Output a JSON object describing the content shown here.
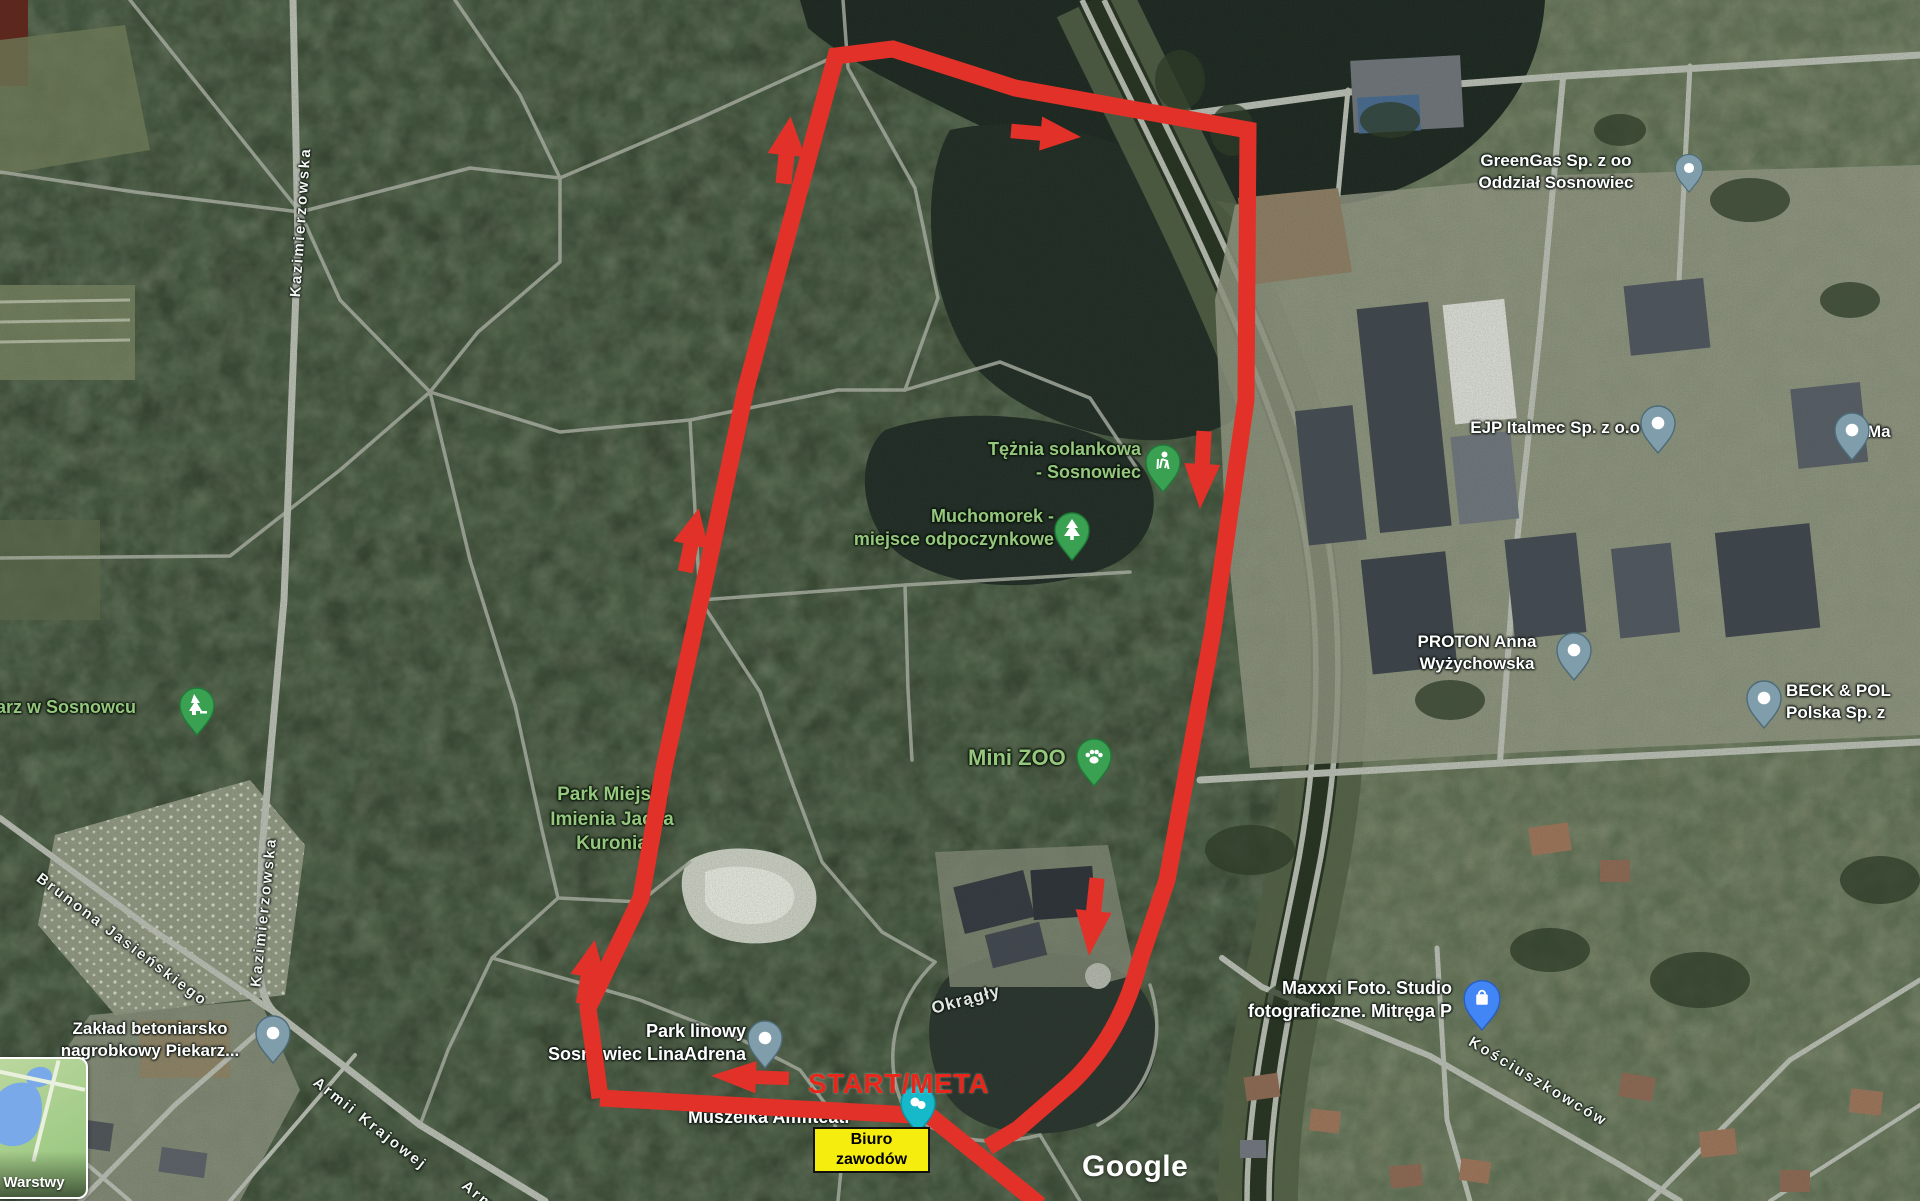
{
  "map_labels": {
    "greengas_line1": "GreenGas Sp. z oo",
    "greengas_line2": "Oddział Sosnowiec",
    "ejp": "EJP Italmec Sp. z o.o",
    "ma_cut": "Ma",
    "proton_line1": "PROTON Anna",
    "proton_line2": "Wyżychowska",
    "beck_line1": "BECK & POL",
    "beck_line2": "Polska Sp. z",
    "maxxxi_line1": "Maxxxi Foto. Studio",
    "maxxxi_line2": "fotograficzne. Mitręga P",
    "teznia_line1": "Tężnia solankowa",
    "teznia_line2": "- Sosnowiec",
    "muchomorek_line1": "Muchomorek -",
    "muchomorek_line2": "miejsce odpoczynkowe",
    "mini_zoo": "Mini ZOO",
    "park_miejski_line1": "Park Miejski",
    "park_miejski_line2": "Imienia Jacka",
    "park_miejski_line3": "Kuronia",
    "cmentarz_cut": "tarz w Sosnowcu",
    "park_linowy_line1": "Park linowy",
    "park_linowy_line2": "Sosnowiec LinaAdrena",
    "muszelka": "Muszelka Amfiteatr",
    "zaklad_line1": "Zakład betoniarsko",
    "zaklad_line2": "nagrobkowy Piekarz...",
    "okragly": "Okrągły"
  },
  "streets": {
    "kazimierzowska_top": "Kazimierzowska",
    "kazimierzowska_bottom": "Kazimierzowska",
    "brunona": "Brunona Jasieńskiego",
    "armii": "Armii Krajowej",
    "armii_cut": "Arm",
    "kosciuszkowcow": "Kościuszkowców"
  },
  "overlay": {
    "start_meta": "START/META",
    "biuro_line1": "Biuro",
    "biuro_line2": "zawodów"
  },
  "ui": {
    "layers_button": "Warstwy",
    "watermark": "Google"
  },
  "colors": {
    "route_red": "#e23128",
    "annotation_yellow": "#f5ed0e",
    "poi_label_green": "#96c77f",
    "pin_green": "#3aa152",
    "pin_gray_blue": "#7f9daa",
    "pin_blue": "#4285f4",
    "pin_teal": "#16b9ca",
    "forest_green": "#2f3b29"
  }
}
